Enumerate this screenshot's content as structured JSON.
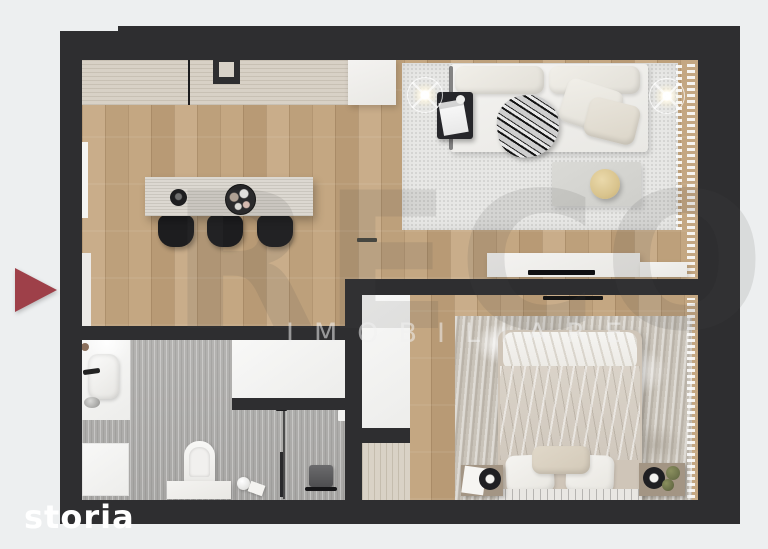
{
  "canvas": {
    "background": "#edeff0"
  },
  "watermark": {
    "brand": "RECO",
    "subtitle": "IMOBILIARE"
  },
  "portal_logo": {
    "text": "storia"
  },
  "entrance_marker": {
    "icon": "entrance-arrow-icon",
    "direction": "right",
    "color": "#9e4049"
  },
  "palette": {
    "wall": "#2e2e30",
    "wood_floor": "#c2a57f",
    "bathroom_tile": "#aeadab",
    "living_rug": "#e7e7e5",
    "bedroom_rug": "#c9c3b9",
    "kitchen_counter": "#d8d1c6",
    "furniture_white": "#f0efec",
    "gold_accent": "#d9c48e",
    "accent_red": "#9e4049"
  },
  "floor_plan": {
    "type": "apartment-top-view-3d-render",
    "rooms": [
      {
        "name": "open-kitchen-living",
        "floor": "wood"
      },
      {
        "name": "bedroom",
        "floor": "wood"
      },
      {
        "name": "bathroom",
        "floor": "gray-tile"
      }
    ]
  }
}
